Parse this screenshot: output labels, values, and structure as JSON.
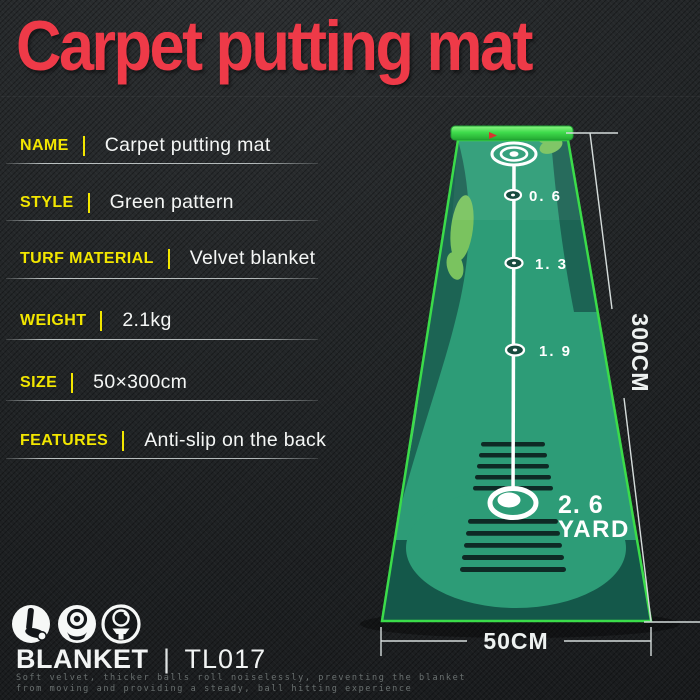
{
  "title": {
    "text": "Carpet putting mat"
  },
  "colors": {
    "title_red": "#ee3a48",
    "label_yellow": "#f2e600",
    "value_white": "#f4f6f5",
    "mat_green": "#2d9c77",
    "mat_dark_green": "#1c6454",
    "mat_bottom_dark": "#14584a",
    "mat_light_green": "#7ac35f",
    "mat_border_green": "#3bdc4a",
    "dimension_line": "#d5dcdb",
    "background": "#202325"
  },
  "specs": {
    "rows": [
      {
        "label": "NAME",
        "value": "Carpet putting mat"
      },
      {
        "label": "STYLE",
        "value": "Green pattern"
      },
      {
        "label": "TURF MATERIAL",
        "value": "Velvet blanket"
      },
      {
        "label": "WEIGHT",
        "value": "2.1kg"
      },
      {
        "label": "SIZE",
        "value": "50×300cm"
      },
      {
        "label": "FEATURES",
        "value": "Anti-slip on the back"
      }
    ]
  },
  "mat": {
    "distance_markers": [
      {
        "label": "0. 6"
      },
      {
        "label": "1. 3"
      },
      {
        "label": "1. 9"
      }
    ],
    "total_distance": {
      "value": "2. 6",
      "unit": "YARD"
    },
    "dimensions": {
      "length": "300CM",
      "width": "50CM"
    }
  },
  "footer": {
    "brand": "BLANKET",
    "divider": "|",
    "model": "TL017",
    "icons": [
      {
        "name": "putter-icon"
      },
      {
        "name": "ball-target-icon"
      },
      {
        "name": "ball-on-tee-icon"
      }
    ],
    "description": {
      "line1": "Soft velvet, thicker balls roll noiselessly, preventing the blanket",
      "line2": "from moving and providing a steady, ball hitting experience"
    }
  }
}
